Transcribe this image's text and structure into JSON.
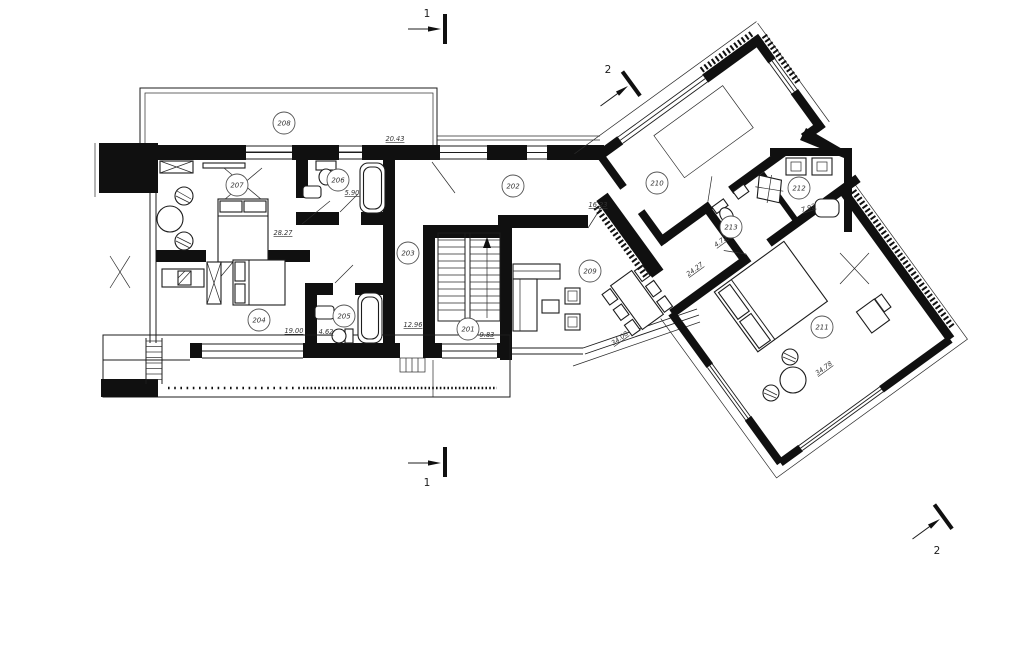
{
  "drawing": {
    "kind": "architectural floor plan",
    "colors": {
      "ink": "#101010",
      "paper": "#ffffff"
    }
  },
  "rooms": [
    {
      "id": "201"
    },
    {
      "id": "202"
    },
    {
      "id": "203"
    },
    {
      "id": "204"
    },
    {
      "id": "205"
    },
    {
      "id": "206"
    },
    {
      "id": "207"
    },
    {
      "id": "208"
    },
    {
      "id": "209"
    },
    {
      "id": "210"
    },
    {
      "id": "211"
    },
    {
      "id": "212"
    },
    {
      "id": "213"
    }
  ],
  "dims": [
    {
      "value": "20.43"
    },
    {
      "value": "5.90"
    },
    {
      "value": "28.27"
    },
    {
      "value": "16.23"
    },
    {
      "value": "19.00"
    },
    {
      "value": "4.62"
    },
    {
      "value": "12.96"
    },
    {
      "value": "9.83"
    },
    {
      "value": "4.72"
    },
    {
      "value": "7.92"
    },
    {
      "value": "24.27"
    },
    {
      "value": "34.08"
    },
    {
      "value": "34.78"
    }
  ],
  "section_markers": {
    "s1": "1",
    "s2": "2"
  }
}
